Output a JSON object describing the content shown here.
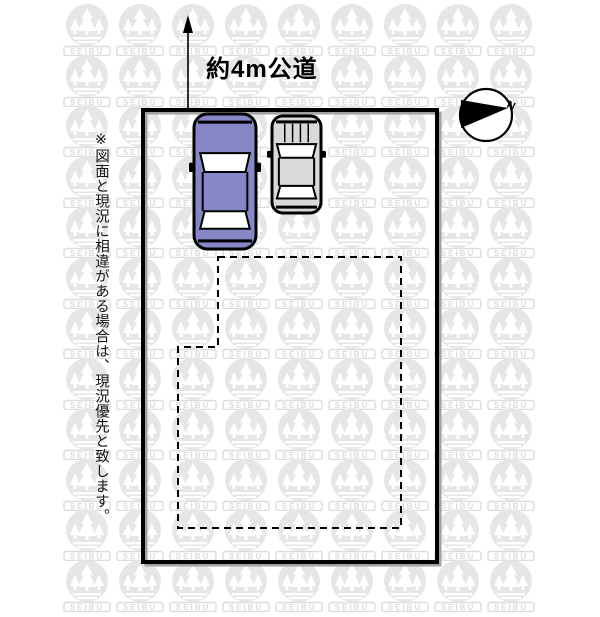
{
  "page": {
    "width": 600,
    "height": 600,
    "background": "#ffffff"
  },
  "watermark": {
    "text": "SEIBU",
    "circle_color": "#e6e6e6",
    "text_color": "#dcdcdc",
    "grid": {
      "cols": 9,
      "rows": 12,
      "x_start": 87,
      "y_start": 25,
      "x_pitch": 53,
      "y_pitch": 50.5
    }
  },
  "diagram": {
    "road_label": "約4m公道",
    "compass_label": "N",
    "disclaimer": "※図面と現況に相違がある場合は、現況優先と致します。",
    "line_color": "#000000",
    "boundary": {
      "x": 143,
      "y": 110,
      "width": 294,
      "height": 452,
      "stroke_width": 4,
      "shadow_color": "#a2a2a2"
    },
    "building_outline": {
      "points": [
        [
          218,
          257
        ],
        [
          401,
          257
        ],
        [
          401,
          528
        ],
        [
          178,
          528
        ],
        [
          178,
          347
        ],
        [
          218,
          347
        ]
      ],
      "dash": "7 5",
      "stroke_width": 2
    },
    "road_arrow": {
      "x": 188,
      "line_top": 30,
      "line_bottom": 109,
      "head": [
        [
          188,
          15
        ],
        [
          183,
          33
        ],
        [
          193,
          33
        ]
      ]
    },
    "compass": {
      "cx": 486,
      "cy": 115,
      "r": 26,
      "needle": [
        [
          461,
          100
        ],
        [
          461,
          128
        ],
        [
          508,
          108
        ]
      ],
      "n_x": 506,
      "n_y": 107,
      "n_rotate": 25
    },
    "cars": [
      {
        "name": "car-blue",
        "x": 194,
        "y": 114,
        "width": 62,
        "height": 135,
        "color": "#8787c8",
        "hood_lines": false
      },
      {
        "name": "car-gray",
        "x": 272,
        "y": 116,
        "width": 49,
        "height": 97,
        "color": "#d9d9d9",
        "hood_lines": true
      }
    ]
  }
}
